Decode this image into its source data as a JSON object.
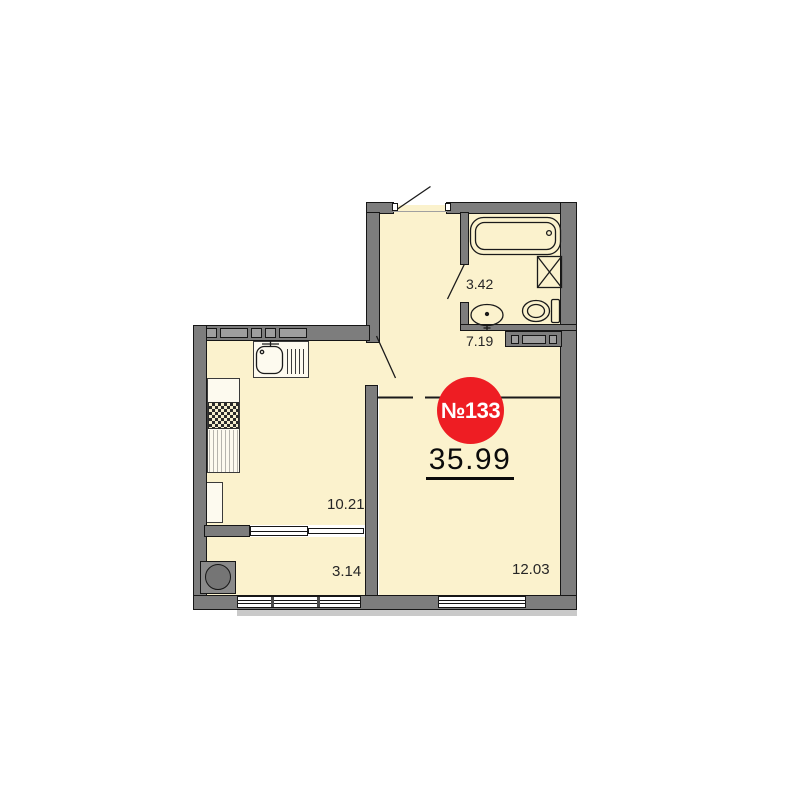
{
  "plan": {
    "badge": {
      "number": "№133",
      "total_area": "35.99"
    },
    "rooms": {
      "bathroom": {
        "name": "bathroom",
        "area": "3.42"
      },
      "hallway": {
        "name": "hallway",
        "area": "7.19"
      },
      "kitchen": {
        "name": "kitchen",
        "area": "10.21"
      },
      "balcony": {
        "name": "balcony",
        "area": "3.14"
      },
      "living_room": {
        "name": "living-room",
        "area": "12.03"
      }
    },
    "colors": {
      "badge_red": "#ee1d23",
      "wall_gray": "#7d7d7d",
      "floor_fill": "#fbf2cd",
      "window_white": "#ffffff"
    },
    "icons": [
      "bathtub-icon",
      "shower-box-icon",
      "toilet-icon",
      "washbasin-icon",
      "kitchen-sink-icon",
      "drying-rack-icon",
      "stove-icon",
      "fridge-icon",
      "column-icon",
      "entrance-door-icon",
      "bathroom-door-icon",
      "kitchen-door-icon",
      "window-icon",
      "vent-shaft-icon"
    ]
  }
}
